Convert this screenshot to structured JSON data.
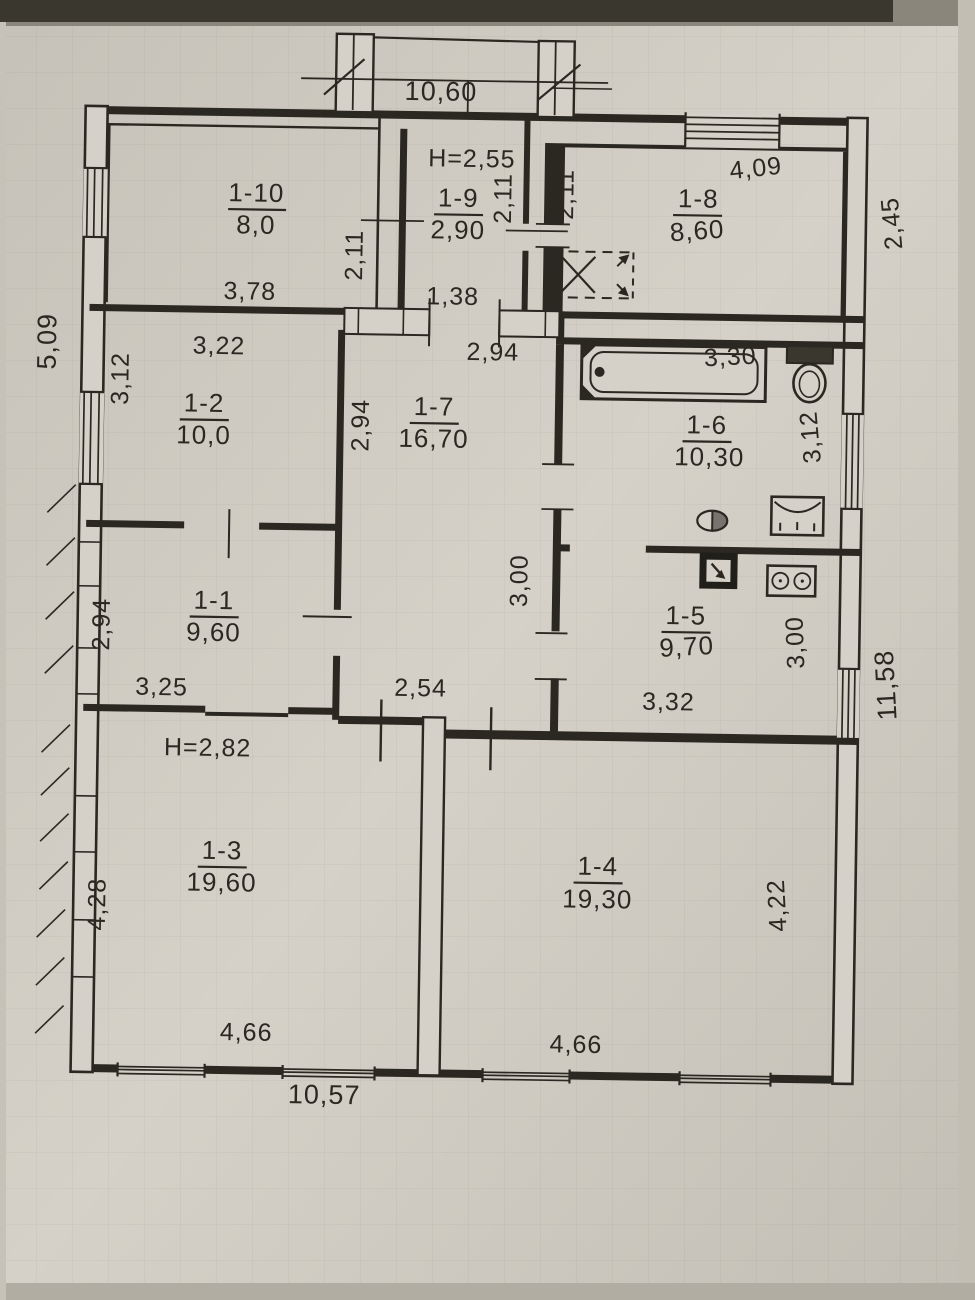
{
  "plan": {
    "overall_dims": {
      "top": "10,60",
      "bottom": "10,57",
      "left": "5,09",
      "right_upper": "2,45",
      "right_lower": "11,58"
    }
  },
  "rooms": [
    {
      "id": "1-1",
      "area": "9,60",
      "dims": {
        "left": "2,94",
        "bottom": "3,25"
      }
    },
    {
      "id": "1-2",
      "area": "10,0",
      "dims": {
        "top": "3,22",
        "left": "3,12"
      }
    },
    {
      "id": "1-3",
      "area": "19,60",
      "height": "H=2,82",
      "dims": {
        "left": "4,28",
        "bottom": "4,66"
      }
    },
    {
      "id": "1-4",
      "area": "19,30",
      "dims": {
        "right": "4,22",
        "bottom": "4,66"
      }
    },
    {
      "id": "1-5",
      "area": "9,70",
      "dims": {
        "right": "3,00",
        "bottom": "3,32"
      }
    },
    {
      "id": "1-6",
      "area": "10,30",
      "dims": {
        "top": "3,30",
        "right": "3,12"
      }
    },
    {
      "id": "1-7",
      "area": "16,70",
      "dims": {
        "top": "2,94",
        "left": "2,94",
        "right": "3,00",
        "bottom": "2,54"
      }
    },
    {
      "id": "1-8",
      "area": "8,60",
      "dims": {
        "top": "4,09",
        "left": "2,11"
      }
    },
    {
      "id": "1-9",
      "area": "2,90",
      "height": "H=2,55",
      "dims": {
        "left": "2,11",
        "right": "2,11",
        "bottom": "1,38"
      }
    },
    {
      "id": "1-10",
      "area": "8,0",
      "dims": {
        "bottom": "3,78"
      }
    }
  ],
  "fixture_icons": [
    "bathtub-icon",
    "toilet-icon",
    "sink-icon",
    "washbasin-icon",
    "boiler-icon",
    "stove-icon"
  ],
  "colors": {
    "paper": "#d5d1c8",
    "ink": "#2b2822"
  }
}
